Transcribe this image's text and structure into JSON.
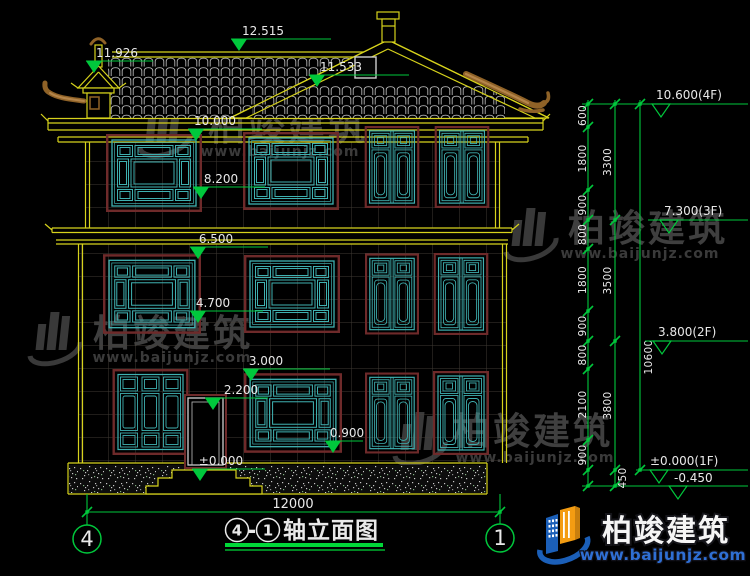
{
  "drawing": {
    "title": {
      "axis_start": "4",
      "dash": "-",
      "axis_end": "1",
      "text": "轴立面图"
    },
    "axis_bubbles": {
      "left": "4",
      "right": "1"
    },
    "elevations": {
      "ridge": "12.515",
      "turret": "11.926",
      "gable": "11.533",
      "eave": "10.000",
      "f4_top": "8.200",
      "f3_band": "6.500",
      "f3_sill": "4.700",
      "f1_top": "3.000",
      "door_top": "2.200",
      "f1_sill": "0.900",
      "ground": "±0.000"
    },
    "levels": {
      "f4": "10.600(4F)",
      "f3": "7.300(3F)",
      "f2": "3.800(2F)",
      "f1": "±0.000(1F)",
      "below": "-0.450"
    },
    "dims": {
      "segments": [
        "600",
        "1800",
        "900",
        "800",
        "1800",
        "900",
        "800",
        "2100",
        "900",
        "450"
      ],
      "subtotals": [
        "3300",
        "3500",
        "3800"
      ],
      "total": "10600",
      "width": "12000"
    }
  },
  "watermark": {
    "brand": "柏竣建筑",
    "url": "www.baijunjz.com"
  },
  "logo": {
    "brand": "柏竣建筑",
    "url": "www.baijunjz.com"
  },
  "colors": {
    "background": "#000000",
    "cad_yellow": "#d6d21c",
    "cad_green": "#00c83c",
    "window_teal": "#3fb0b0",
    "frame_maroon": "#6e2a2a",
    "tile_gray": "#b4b4b4",
    "watermark_gray": "#4a4a4a",
    "logo_blue": "#1b5fb8",
    "logo_orange": "#f39c12"
  }
}
